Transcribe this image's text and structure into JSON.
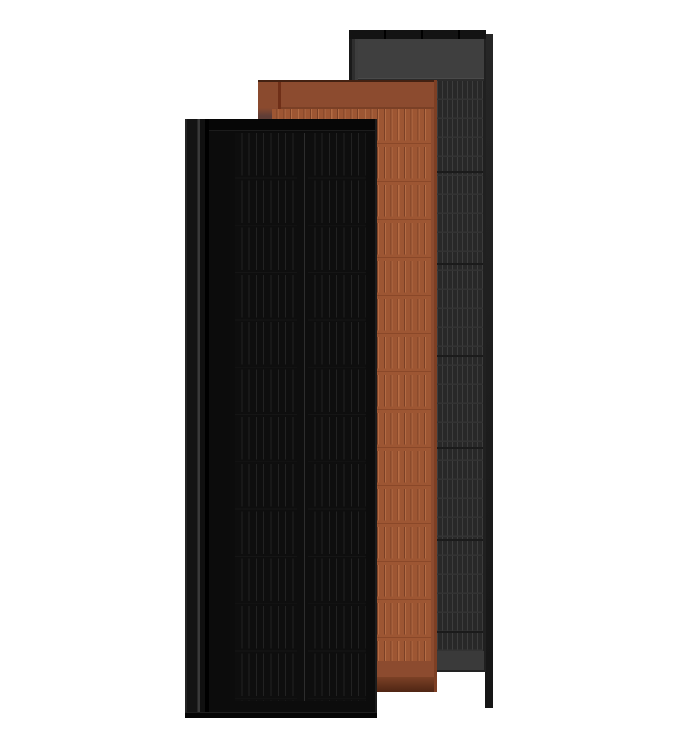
{
  "scene": {
    "description": "Product render of three overlapping rooftop solar panel modules: matte black (front), terracotta (middle), slate gray (back)",
    "panels": [
      {
        "id": "slate-gray-panel",
        "position": "back",
        "face_color": "#282828"
      },
      {
        "id": "terracotta-panel",
        "position": "middle",
        "face_color": "#9d5633"
      },
      {
        "id": "black-panel",
        "position": "front",
        "face_color": "#0c0c0c"
      }
    ]
  },
  "colors": {
    "background": "#ffffff",
    "gray": {
      "frame": "#202020",
      "frame_highlight": "#3d3d3d",
      "top_strip": "#131313",
      "divider": "#000000",
      "header": "#3f3f3f",
      "groove": "#2b2b2b",
      "cell_bg": "#282828",
      "cell_line": "#3d3d3d",
      "row_line": "#333333",
      "section_line": "#1b1b1b",
      "bottom_band": "#3a3a3a",
      "side_top": "#262626",
      "side_bottom": "#161616"
    },
    "terracotta": {
      "top_line": "#432112",
      "header": "#8c4b2f",
      "groove": "#7a4026",
      "flange": "#8a4a2e",
      "flange_shadow": "#5f3d36",
      "seam": "#6f2f18",
      "cell_bg": "#9d5633",
      "pill_light": "#b46c44",
      "pill_dark": "#7b4026",
      "row_line": "#8a4829",
      "shadow_top": "#7b4126",
      "shadow_bottom": "#5a2c18",
      "right_edge": "#7d3f24"
    },
    "black": {
      "face": "#0c0c0c",
      "top_strip": "#060606",
      "rail_edge": "#242424",
      "rail_dark": "#141414",
      "rail_highlight": "#3a3a3a",
      "rail_gap": "#000000",
      "cell_bg": "#0e0e0e",
      "cell_line": "#222222",
      "center_line": "#2d2d2d",
      "row_line": "#151515",
      "edge_line": "#1c1c1c",
      "bottom_edge": "#050505"
    }
  }
}
